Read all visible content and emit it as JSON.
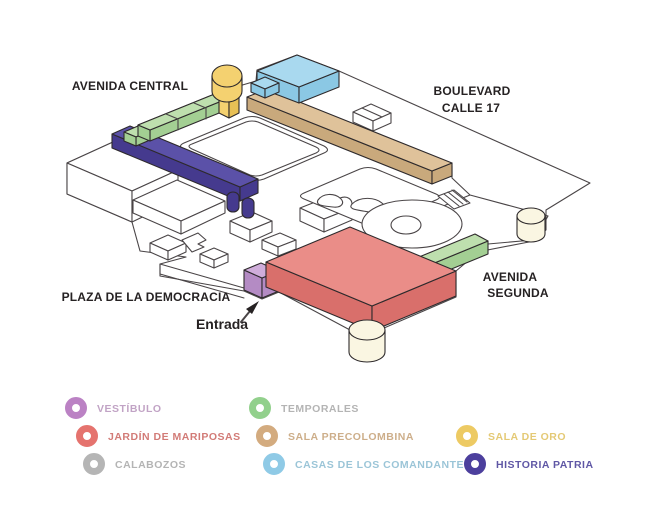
{
  "map": {
    "labels": {
      "avenida_central": "AVENIDA CENTRAL",
      "boulevard_1": "BOULEVARD",
      "boulevard_2": "CALLE 17",
      "avenida_segunda_1": "AVENIDA",
      "avenida_segunda_2": "SEGUNDA",
      "plaza": "PLAZA DE LA DEMOCRACIA",
      "entrada": "Entrada"
    },
    "areas": {
      "vestibulo": {
        "fill": "#cfadda",
        "side": "#b48bc4"
      },
      "jardin": {
        "fill": "#ea8d88",
        "side": "#d96f6b"
      },
      "temporales": {
        "fill": "#bedfae",
        "side": "#a3cf93"
      },
      "precolombina": {
        "fill": "#dfc29a",
        "side": "#c9a97c"
      },
      "casas": {
        "fill": "#a9d9ef",
        "side": "#8bc8e4"
      },
      "oro": {
        "fill": "#f4d170",
        "side": "#e8c055"
      },
      "historia": {
        "fill": "#5b51a8",
        "side": "#453a8e"
      },
      "cream": {
        "fill": "#faf6e2",
        "side": "#faf6e2"
      }
    }
  },
  "legend": {
    "items": [
      {
        "id": "vestibulo",
        "label": "VESTÍBULO",
        "color": "#bb82c4",
        "text_color": "#b794bb"
      },
      {
        "id": "jardin",
        "label": "JARDÍN DE MARIPOSAS",
        "color": "#e5736e",
        "text_color": "#cb6560"
      },
      {
        "id": "calabozos",
        "label": "CALABOZOS",
        "color": "#b5b5b5",
        "text_color": "#a8a8a8"
      },
      {
        "id": "temporales",
        "label": "TEMPORALES",
        "color": "#92d08c",
        "text_color": "#a8a8a8"
      },
      {
        "id": "precolombina",
        "label": "SALA PRECOLOMBINA",
        "color": "#d3ab7f",
        "text_color": "#c5a176"
      },
      {
        "id": "casas",
        "label": "CASAS DE LOS COMANDANTES",
        "color": "#8fcae6",
        "text_color": "#8abbd1"
      },
      {
        "id": "oro",
        "label": "SALA DE ORO",
        "color": "#edca63",
        "text_color": "#e0c05e"
      },
      {
        "id": "historia",
        "label": "HISTORIA PATRIA",
        "color": "#4c3f9d",
        "text_color": "#443a96"
      }
    ]
  }
}
